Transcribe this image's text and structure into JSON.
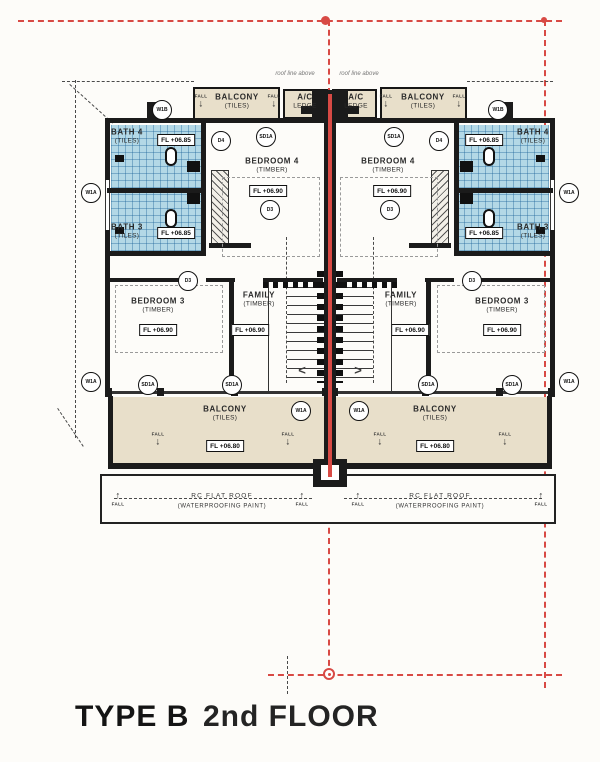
{
  "title": {
    "type": "TYPE B",
    "floor": "2nd FLOOR"
  },
  "colors": {
    "tile_blue": "#b3d8e6",
    "beige": "#e8dfca",
    "wall": "#1b1b1b",
    "grid_red": "#d84a45"
  },
  "plan": {
    "rooms": [
      {
        "name": "BALCONY",
        "sub": "(TILES)",
        "x": 237,
        "y": 101
      },
      {
        "name": "A/C",
        "sub": "LEDGE",
        "x": 305,
        "y": 101
      },
      {
        "name": "A/C",
        "sub": "LEDGE",
        "x": 356,
        "y": 101
      },
      {
        "name": "BALCONY",
        "sub": "(TILES)",
        "x": 423,
        "y": 101
      },
      {
        "name": "BATH 4",
        "sub": "(TILES)",
        "x": 127,
        "y": 136
      },
      {
        "name": "BATH 4",
        "sub": "(TILES)",
        "x": 533,
        "y": 136
      },
      {
        "name": "BATH 3",
        "sub": "(TILES)",
        "x": 127,
        "y": 231
      },
      {
        "name": "BATH 3",
        "sub": "(TILES)",
        "x": 533,
        "y": 231
      },
      {
        "name": "BEDROOM 4",
        "sub": "(TIMBER)",
        "x": 272,
        "y": 165
      },
      {
        "name": "BEDROOM 4",
        "sub": "(TIMBER)",
        "x": 388,
        "y": 165
      },
      {
        "name": "BEDROOM 3",
        "sub": "(TIMBER)",
        "x": 158,
        "y": 305
      },
      {
        "name": "BEDROOM 3",
        "sub": "(TIMBER)",
        "x": 502,
        "y": 305
      },
      {
        "name": "FAMILY",
        "sub": "(TIMBER)",
        "x": 259,
        "y": 299
      },
      {
        "name": "FAMILY",
        "sub": "(TIMBER)",
        "x": 401,
        "y": 299
      },
      {
        "name": "BALCONY",
        "sub": "(TILES)",
        "x": 225,
        "y": 413
      },
      {
        "name": "BALCONY",
        "sub": "(TILES)",
        "x": 435,
        "y": 413
      }
    ],
    "fl_boxes": [
      {
        "text": "FL +06.85",
        "x": 176,
        "y": 140
      },
      {
        "text": "FL +06.85",
        "x": 484,
        "y": 140
      },
      {
        "text": "FL +06.85",
        "x": 176,
        "y": 233
      },
      {
        "text": "FL +06.85",
        "x": 484,
        "y": 233
      },
      {
        "text": "FL +06.90",
        "x": 268,
        "y": 191
      },
      {
        "text": "FL +06.90",
        "x": 392,
        "y": 191
      },
      {
        "text": "FL +06.90",
        "x": 158,
        "y": 330
      },
      {
        "text": "FL +06.90",
        "x": 502,
        "y": 330
      },
      {
        "text": "FL +06.90",
        "x": 250,
        "y": 330
      },
      {
        "text": "FL +06.90",
        "x": 410,
        "y": 330
      },
      {
        "text": "FL +06.80",
        "x": 225,
        "y": 446
      },
      {
        "text": "FL +06.80",
        "x": 435,
        "y": 446
      }
    ],
    "circles": [
      {
        "text": "W1B",
        "x": 162,
        "y": 110
      },
      {
        "text": "W1B",
        "x": 498,
        "y": 110
      },
      {
        "text": "D4",
        "x": 221,
        "y": 141
      },
      {
        "text": "D4",
        "x": 439,
        "y": 141
      },
      {
        "text": "SD1A",
        "x": 266,
        "y": 137
      },
      {
        "text": "SD1A",
        "x": 394,
        "y": 137
      },
      {
        "text": "W1A",
        "x": 91,
        "y": 193
      },
      {
        "text": "W1A",
        "x": 569,
        "y": 193
      },
      {
        "text": "D3",
        "x": 270,
        "y": 210
      },
      {
        "text": "D3",
        "x": 390,
        "y": 210
      },
      {
        "text": "D3",
        "x": 188,
        "y": 281
      },
      {
        "text": "D3",
        "x": 472,
        "y": 281
      },
      {
        "text": "W1A",
        "x": 91,
        "y": 382
      },
      {
        "text": "W1A",
        "x": 569,
        "y": 382
      },
      {
        "text": "SD1A",
        "x": 148,
        "y": 385
      },
      {
        "text": "SD1A",
        "x": 512,
        "y": 385
      },
      {
        "text": "SD1A",
        "x": 232,
        "y": 385
      },
      {
        "text": "SD1A",
        "x": 428,
        "y": 385
      },
      {
        "text": "W1A",
        "x": 301,
        "y": 411
      },
      {
        "text": "W1A",
        "x": 359,
        "y": 411
      }
    ],
    "falls": [
      {
        "text": "FALL",
        "dir": "down",
        "x": 201,
        "y": 102
      },
      {
        "text": "FALL",
        "dir": "down",
        "x": 274,
        "y": 102
      },
      {
        "text": "FALL",
        "dir": "down",
        "x": 386,
        "y": 102
      },
      {
        "text": "FALL",
        "dir": "down",
        "x": 459,
        "y": 102
      },
      {
        "text": "FALL",
        "dir": "down",
        "x": 158,
        "y": 440
      },
      {
        "text": "FALL",
        "dir": "down",
        "x": 288,
        "y": 440
      },
      {
        "text": "FALL",
        "dir": "down",
        "x": 380,
        "y": 440
      },
      {
        "text": "FALL",
        "dir": "down",
        "x": 505,
        "y": 440
      },
      {
        "text": "FALL",
        "dir": "up",
        "x": 118,
        "y": 499
      },
      {
        "text": "FALL",
        "dir": "up",
        "x": 302,
        "y": 499
      },
      {
        "text": "FALL",
        "dir": "up",
        "x": 358,
        "y": 499
      },
      {
        "text": "FALL",
        "dir": "up",
        "x": 541,
        "y": 499
      }
    ],
    "stair_arrows": [
      {
        "glyph": "<",
        "x": 302,
        "y": 370
      },
      {
        "glyph": ">",
        "x": 358,
        "y": 370
      }
    ],
    "small_notes": [
      {
        "text": "roof line above",
        "x": 295,
        "y": 74
      },
      {
        "text": "roof line above",
        "x": 359,
        "y": 74
      }
    ],
    "roof_texts": [
      {
        "l1": "RC FLAT ROOF",
        "l2": "(WATERPROOFING PAINT)",
        "x": 222,
        "y": 501
      },
      {
        "l1": "RC FLAT ROOF",
        "l2": "(WATERPROOFING PAINT)",
        "x": 440,
        "y": 501
      }
    ]
  }
}
